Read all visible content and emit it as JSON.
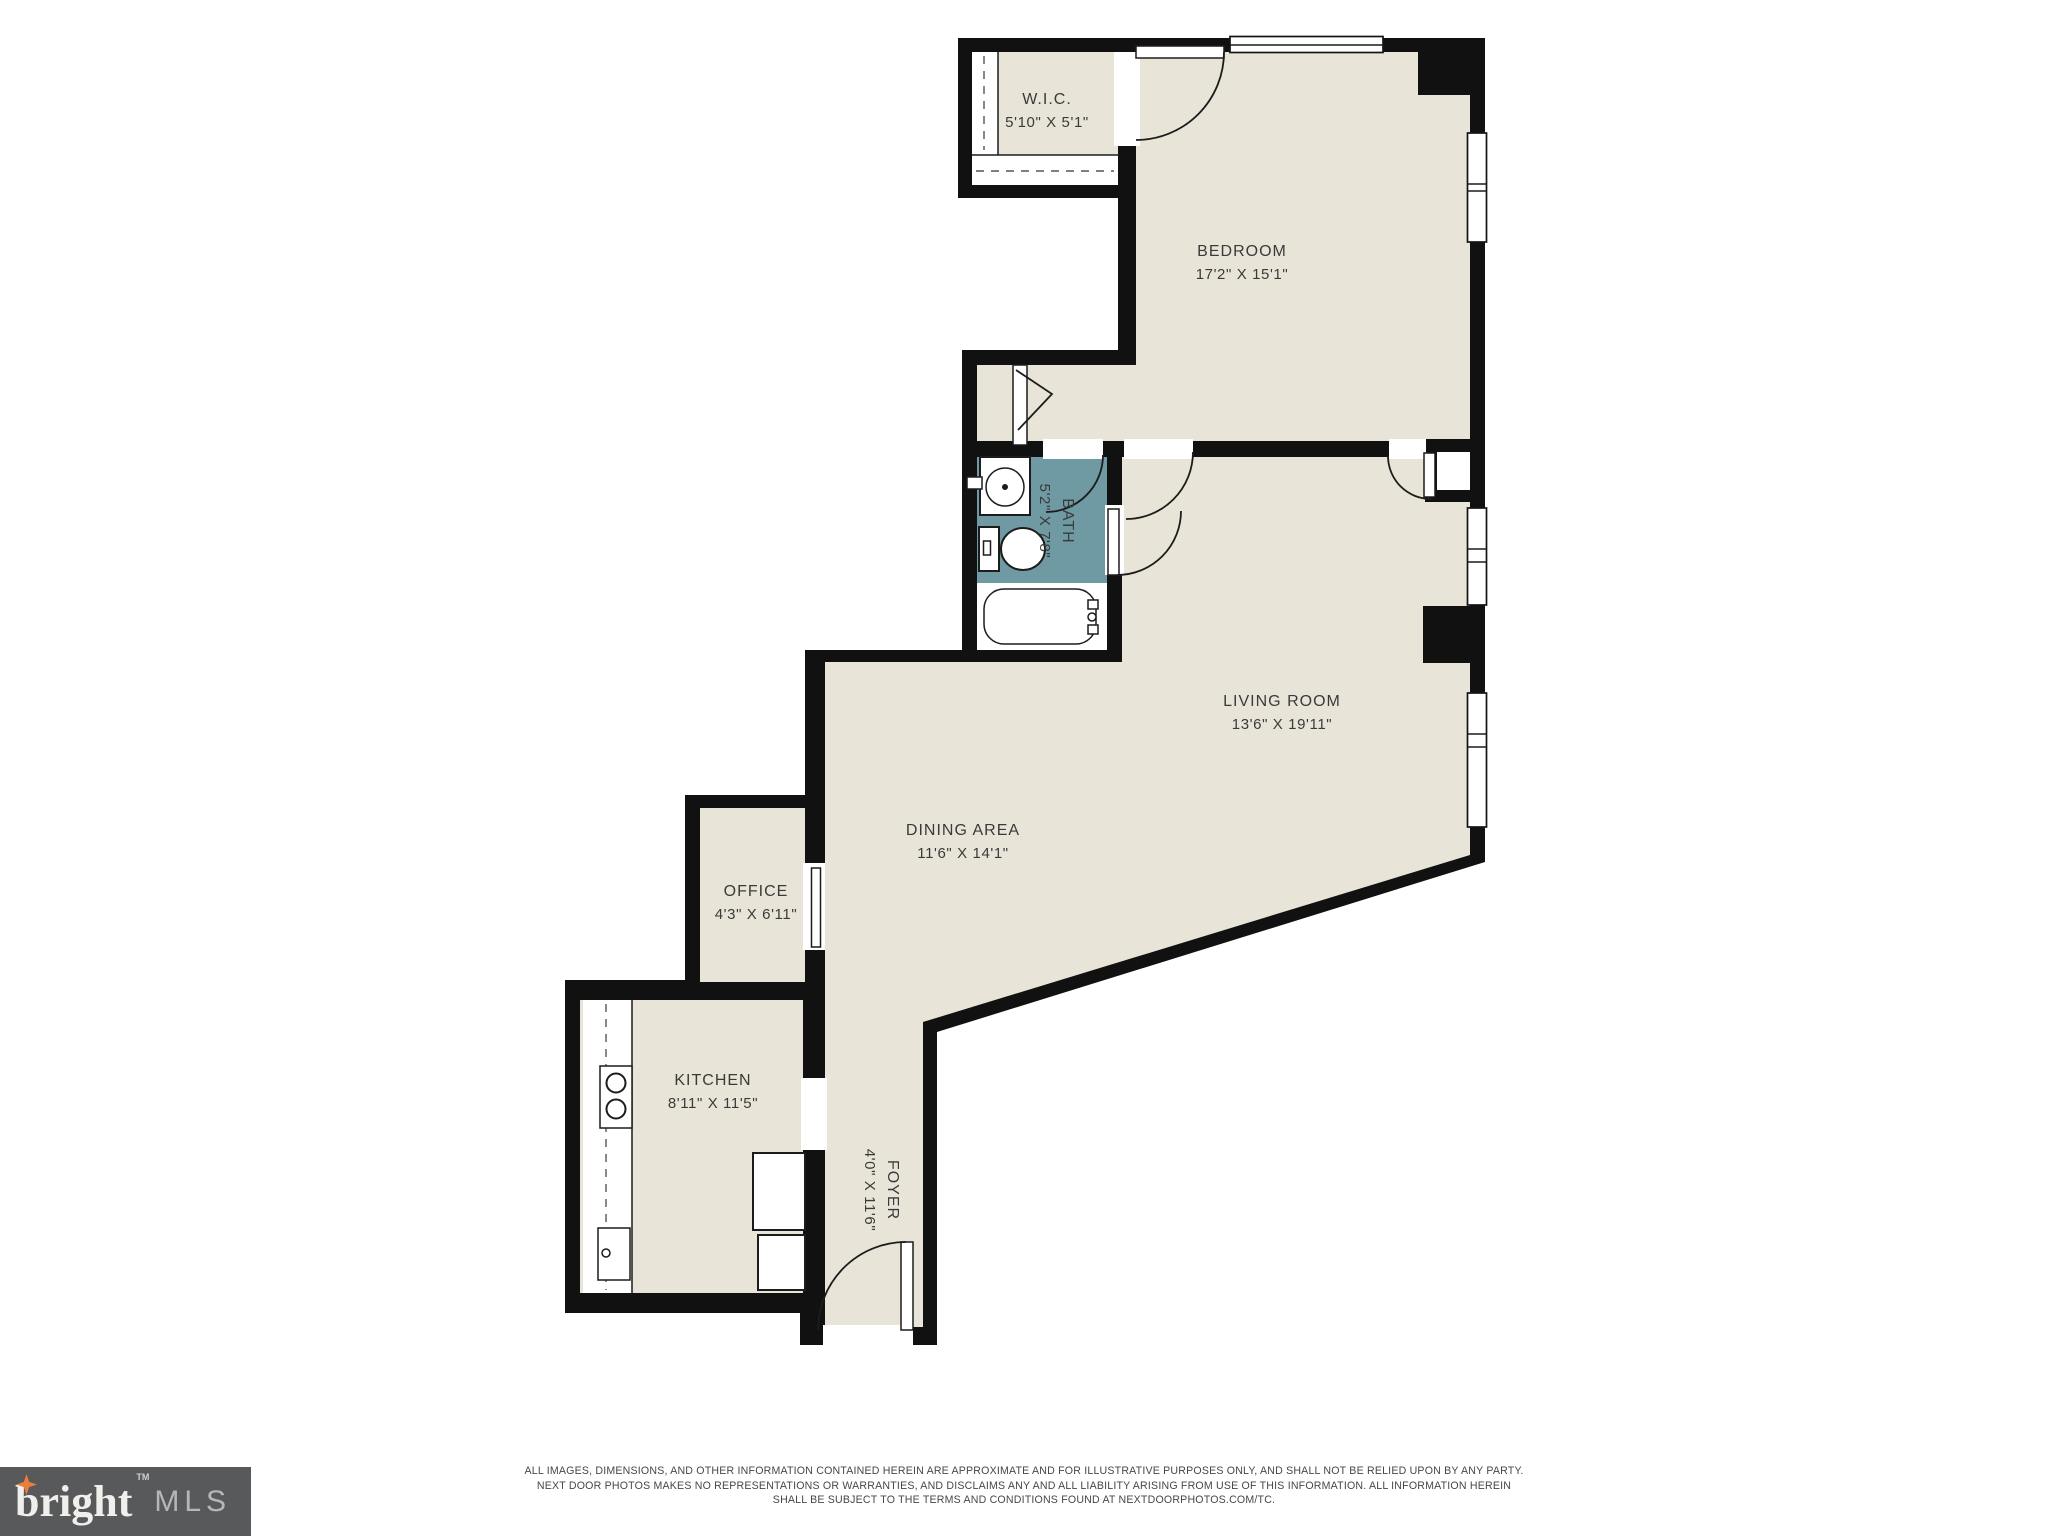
{
  "plan": {
    "rooms": [
      {
        "id": "wic",
        "name": "W.I.C.",
        "dims": "5'10\" X 5'1\""
      },
      {
        "id": "bedroom",
        "name": "BEDROOM",
        "dims": "17'2\" X 15'1\""
      },
      {
        "id": "bath",
        "name": "BATH",
        "dims": "5'2\" X 7'8\""
      },
      {
        "id": "living",
        "name": "LIVING ROOM",
        "dims": "13'6\" X 19'11\""
      },
      {
        "id": "dining",
        "name": "DINING AREA",
        "dims": "11'6\" X 14'1\""
      },
      {
        "id": "office",
        "name": "OFFICE",
        "dims": "4'3\" X 6'11\""
      },
      {
        "id": "kitchen",
        "name": "KITCHEN",
        "dims": "8'11\" X 11'5\""
      },
      {
        "id": "foyer",
        "name": "FOYER",
        "dims": "4'0\" X 11'6\""
      }
    ]
  },
  "branding": {
    "logo_word": "bright",
    "logo_mls": "MLS",
    "trademark": "TM"
  },
  "disclaimer": {
    "line1": "ALL IMAGES, DIMENSIONS, AND OTHER INFORMATION CONTAINED HEREIN ARE APPROXIMATE AND FOR ILLUSTRATIVE PURPOSES ONLY, AND SHALL NOT BE RELIED UPON BY ANY PARTY.",
    "line2": "NEXT DOOR PHOTOS MAKES NO REPRESENTATIONS OR WARRANTIES, AND DISCLAIMS ANY AND ALL LIABILITY ARISING FROM USE OF THIS INFORMATION. ALL INFORMATION HEREIN",
    "line3": "SHALL BE SUBJECT TO THE TERMS AND CONDITIONS FOUND AT NEXTDOORPHOTOS.COM/TC."
  },
  "colors": {
    "wall": "#111111",
    "floor": "#e8e5d8",
    "bath": "#6f9aa4",
    "logobg": "#58595b",
    "star": "#e87f3d",
    "ink": "#3a3a3a"
  }
}
